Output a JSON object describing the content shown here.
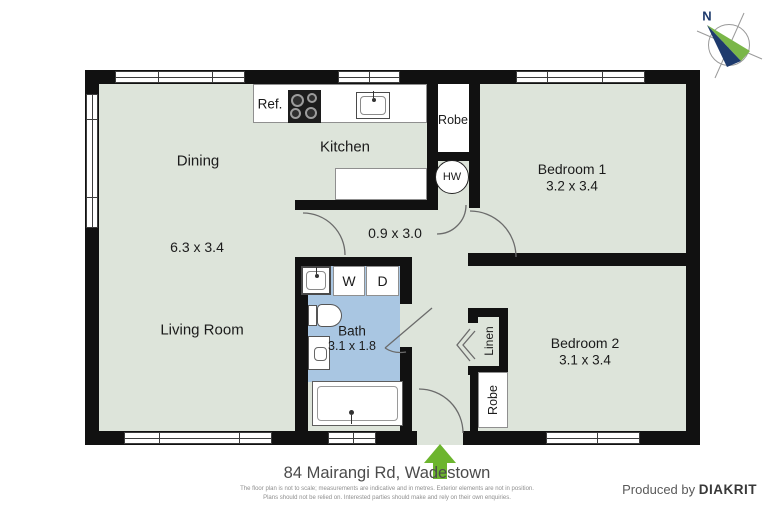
{
  "rooms": {
    "dining": {
      "name": "Dining",
      "dims": "6.3 x 3.4"
    },
    "kitchen": {
      "name": "Kitchen"
    },
    "living": {
      "name": "Living Room"
    },
    "bed1": {
      "name": "Bedroom 1",
      "dims": "3.2 x 3.4"
    },
    "bed2": {
      "name": "Bedroom 2",
      "dims": "3.1 x 3.4"
    },
    "bath": {
      "name": "Bath",
      "dims": "3.1 x 1.8"
    },
    "hall": {
      "dims": "0.9 x 3.0"
    }
  },
  "fixtures": {
    "fridge": "Ref.",
    "robe1": "Robe",
    "hw": "HW",
    "washer": "W",
    "dryer": "D",
    "linen": "Linen",
    "robe2": "Robe"
  },
  "compass": {
    "label": "N"
  },
  "footer": {
    "address": "84 Mairangi Rd, Wadestown",
    "disclaimer1": "The floor plan is not to scale; measurements are indicative and in metres. Exterior elements are not in position.",
    "disclaimer2": "Plans should not be relied on. Interested parties should make and rely on their own enquiries.",
    "credit_prefix": "Produced by",
    "credit_brand": "DIAKRIT"
  },
  "colors": {
    "floor": "#dde4da",
    "bath_blue": "#a9c6e2",
    "wall": "#111111",
    "arrow_green": "#6cb52e",
    "compass_green": "#7ab648",
    "compass_navy": "#1e3a6d"
  }
}
